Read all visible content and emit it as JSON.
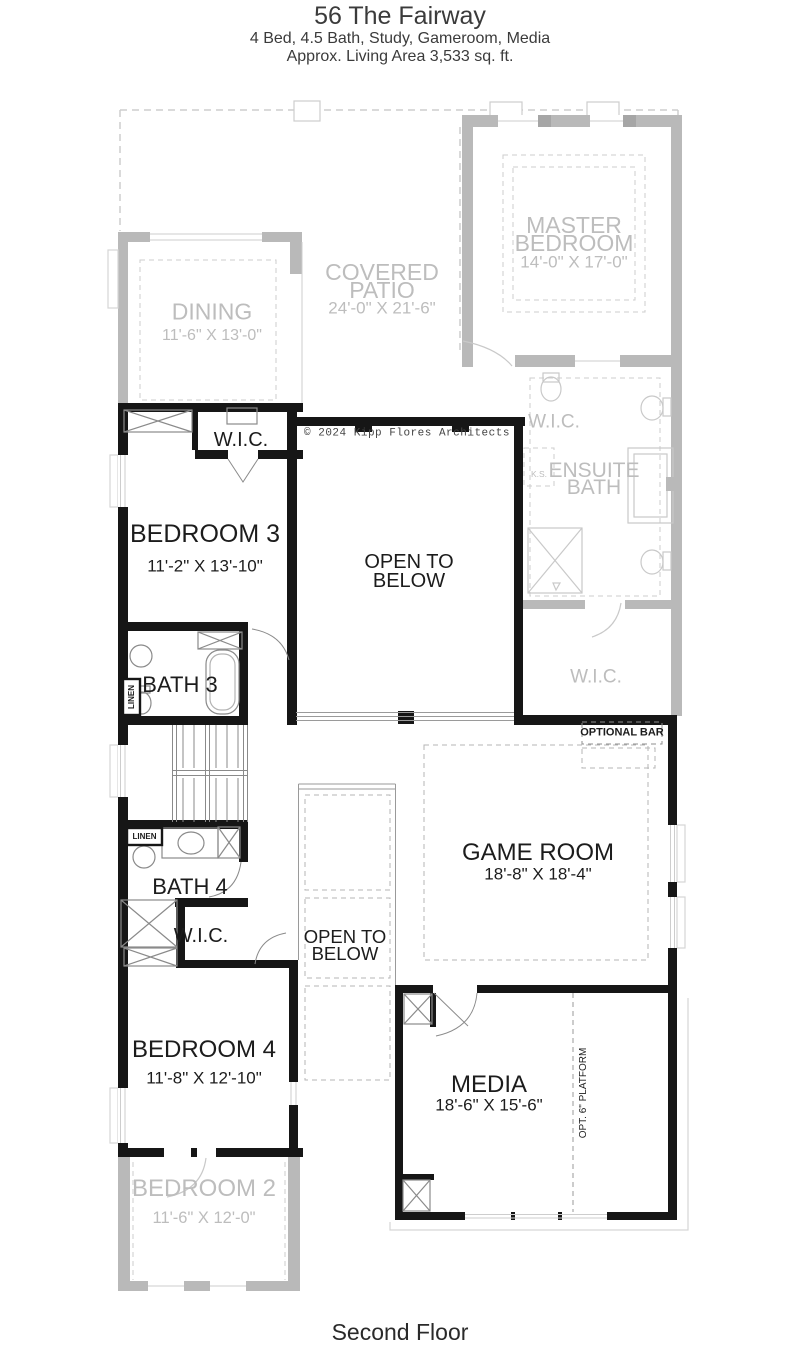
{
  "header": {
    "title": "56 The Fairway",
    "subtitle": "4 Bed, 4.5 Bath, Study, Gameroom, Media",
    "area_line": "Approx. Living Area 3,533 sq. ft."
  },
  "footer": {
    "label": "Second Floor"
  },
  "copyright": "© 2024 Kipp Flores Architects",
  "colors": {
    "wall_active": "#161616",
    "wall_below": "#b9b9b9",
    "label_below": "#bdbdbd",
    "label_active": "#1c1c1c"
  },
  "rooms": {
    "master_bedroom": {
      "name": "MASTER BEDROOM",
      "dims": "14'-0\" X 17'-0\""
    },
    "dining": {
      "name": "DINING",
      "dims": "11'-6\" X 13'-0\""
    },
    "covered_patio": {
      "name": "COVERED PATIO",
      "dims": "24'-0\" X 21'-6\""
    },
    "bedroom_2": {
      "name": "BEDROOM 2",
      "dims": "11'-6\" X 12'-0\""
    },
    "bedroom_3": {
      "name": "BEDROOM 3",
      "dims": "11'-2\" X 13'-10\""
    },
    "bedroom_4": {
      "name": "BEDROOM 4",
      "dims": "11'-8\" X 12'-10\""
    },
    "game_room": {
      "name": "GAME ROOM",
      "dims": "18'-8\" X 18'-4\""
    },
    "media": {
      "name": "MEDIA",
      "dims": "18'-6\" X 15'-6\""
    },
    "bath_3": {
      "name": "BATH 3"
    },
    "bath_4": {
      "name": "BATH 4"
    },
    "ensuite_bath": {
      "name": "ENSUITE BATH"
    },
    "wic_bedroom3": {
      "name": "W.I.C."
    },
    "wic_bedroom4": {
      "name": "W.I.C."
    },
    "wic_master_upper": {
      "name": "W.I.C."
    },
    "wic_master_lower": {
      "name": "W.I.C."
    },
    "open_to_below_upper": {
      "name": "OPEN TO BELOW"
    },
    "open_to_below_lower": {
      "name": "OPEN TO BELOW"
    }
  },
  "annotations": {
    "optional_bar": "OPTIONAL BAR",
    "opt_platform": "OPT. 6\" PLATFORM",
    "linen_bath3": "LINEN",
    "linen_bath4": "LINEN",
    "ks": "K.S."
  }
}
